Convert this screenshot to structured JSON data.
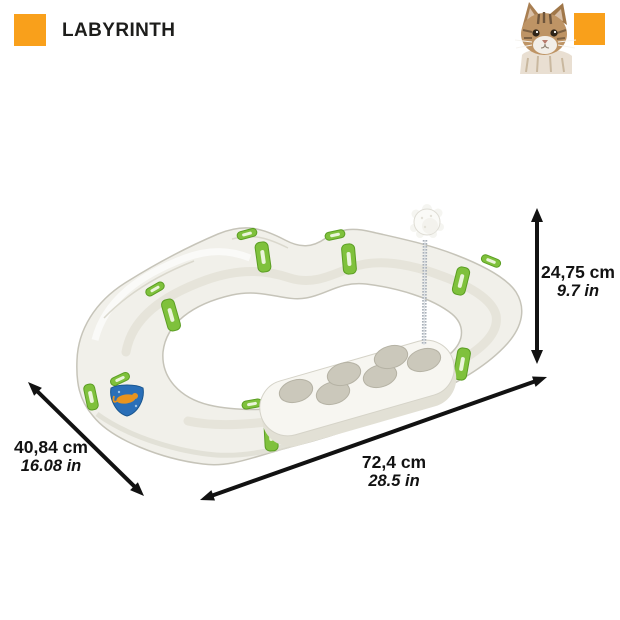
{
  "header": {
    "title": "LABYRINTH"
  },
  "brand": {
    "accent_color": "#F9A01B"
  },
  "photo": {
    "subject": "tabby-cat"
  },
  "product": {
    "name": "labyrinth-cat-play-track",
    "track_color": "#F1F0EA",
    "clip_color": "#7FC13C",
    "sticker_color": "#2A6FB8"
  },
  "dimensions": {
    "height": {
      "metric": "24,75 cm",
      "imperial": "9.7 in"
    },
    "length": {
      "metric": "72,4 cm",
      "imperial": "28.5 in"
    },
    "depth": {
      "metric": "40,84 cm",
      "imperial": "16.08 in"
    }
  }
}
